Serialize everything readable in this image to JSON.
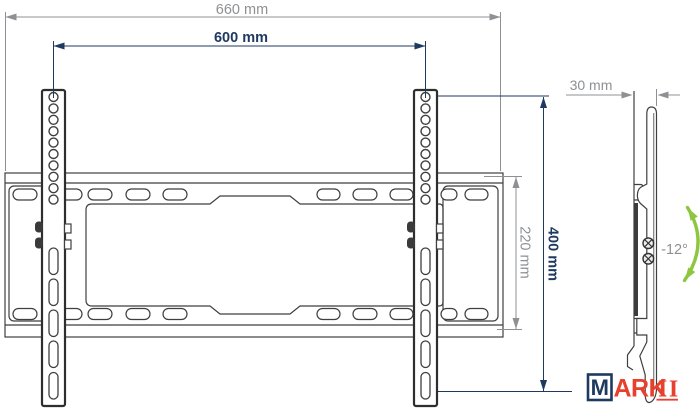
{
  "drawing": {
    "dim_overall_width": "660 mm",
    "dim_mount_width": "600 mm",
    "dim_mount_height": "400 mm",
    "dim_plate_height": "220 mm",
    "dim_profile_depth": "30 mm",
    "tilt_angle": "-12°"
  },
  "logo": {
    "boxed_letter": "M",
    "name_part": "ARK",
    "name_suffix": "II"
  },
  "colors": {
    "dimension_primary": "#1f3a60",
    "dimension_secondary": "#8e9093",
    "drawing_outline": "#3f3f3f",
    "tilt_arrow_green": "#8dc63f",
    "logo_red": "#e8402c",
    "logo_navy": "#1e3a5f"
  }
}
